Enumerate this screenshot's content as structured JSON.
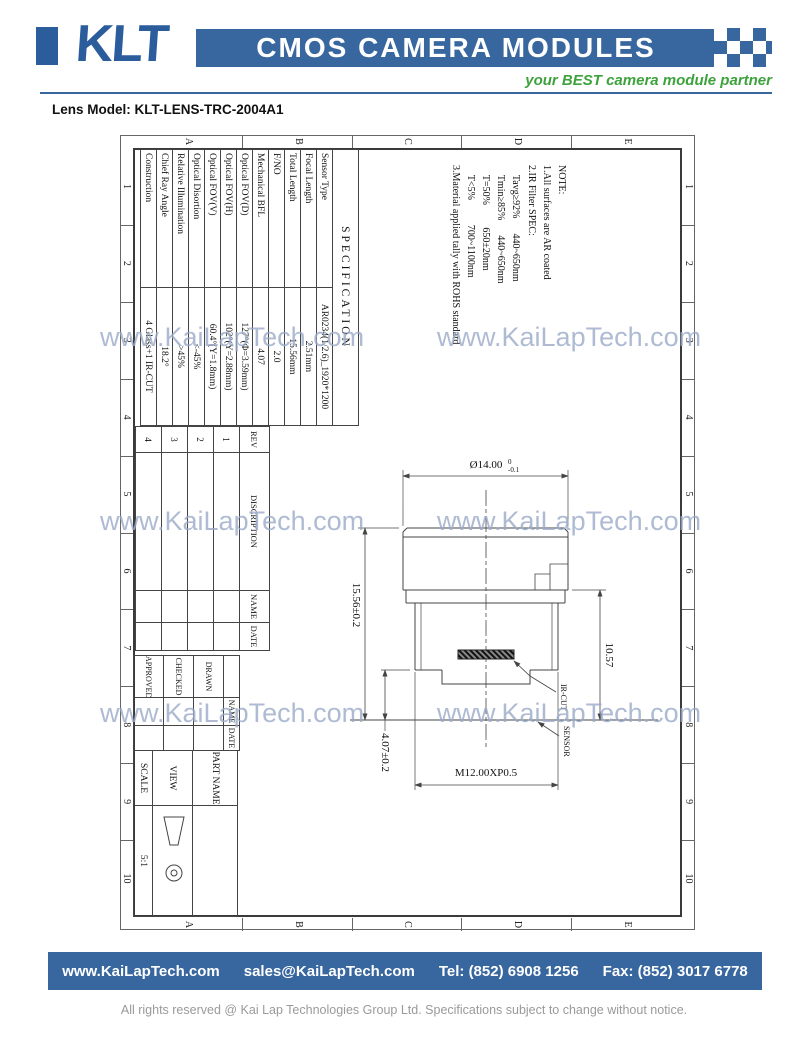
{
  "colors": {
    "brand_blue": "#38679F",
    "logo_blue": "#2B5C9C",
    "accent_green": "#3EA23C",
    "watermark_blue": "#9AABC9",
    "copyright_gray": "#9A9A9A",
    "line_dark": "#3A3A3A"
  },
  "header": {
    "logo_text": "KLT",
    "title": "CMOS CAMERA MODULES",
    "tagline": "your BEST camera module partner"
  },
  "lens_model": "Lens Model: KLT-LENS-TRC-2004A1",
  "watermark": {
    "text": "www.KaiLapTech.com"
  },
  "drawing": {
    "zones": {
      "columns": [
        "1",
        "2",
        "3",
        "4",
        "5",
        "6",
        "7",
        "8",
        "9",
        "10"
      ],
      "rows": [
        "A",
        "B",
        "C",
        "D",
        "E"
      ]
    },
    "note": {
      "lines": [
        "NOTE:",
        "1.All surfaces are AR coated",
        "2.IR Filter SPEC:",
        "    Tavg≥92%      440~650nm",
        "    Tmin≥85%      440~650nm",
        "    T=50%         650±20nm",
        "    T<5%          700~1100nm",
        "3.Material applied tally with ROHS standard"
      ]
    },
    "spec_table": {
      "title": "SPECIFICATION",
      "rows": [
        {
          "label": "Sensor Type",
          "value": "AR0234(1/2.6)_1920*1200"
        },
        {
          "label": "Focal Length",
          "value": "2.51mm"
        },
        {
          "label": "Total Length",
          "value": "15.56mm"
        },
        {
          "label": "F/NO",
          "value": "2.0"
        },
        {
          "label": "Mechanical BFL",
          "value": "4.07"
        },
        {
          "label": "Optical FOV(D)",
          "value": "127°(Φ=3.59mm)"
        },
        {
          "label": "Optical FOV(H)",
          "value": "102°(Y=2.88mm)"
        },
        {
          "label": "Optical FOV(V)",
          "value": "60.4°(Y=1.8mm)"
        },
        {
          "label": "Optical Disortion",
          "value": "<-45%"
        },
        {
          "label": "Relative Illumination",
          "value": ">45%"
        },
        {
          "label": "Chief Ray Angle",
          "value": "18.2°"
        },
        {
          "label": "Construction",
          "value": "4 Glass+1 IR-CUT"
        }
      ]
    },
    "rev_table": {
      "headers": [
        "REV",
        "DISCRIPTION",
        "NAME",
        "DATE"
      ],
      "rows": [
        "1",
        "2",
        "3",
        "4"
      ]
    },
    "approval_table": {
      "col_headers": [
        "NAME",
        "DATE"
      ],
      "row_labels": [
        "DRAWN",
        "CHECKED",
        "APPROVED"
      ]
    },
    "title_block": {
      "part_name_label": "PART NAME",
      "view_label": "VIEW",
      "scale_label": "SCALE",
      "scale_value": "5:1"
    },
    "dims": {
      "front_diameter": "Ø14.00",
      "front_diameter_tol_upper": "0",
      "front_diameter_tol_lower": "-0.1",
      "total_length": "15.56±0.2",
      "flange_to_sensor": "10.57",
      "rear_to_sensor": "4.07±0.2",
      "thread_spec": "M12.00XP0.5",
      "ir_cut_label": "IR-CUT",
      "sensor_label": "SENSOR"
    }
  },
  "footer": {
    "website": "www.KaiLapTech.com",
    "email": "sales@KaiLapTech.com",
    "tel": "Tel: (852) 6908 1256",
    "fax": "Fax: (852) 3017 6778",
    "copyright": "All rights reserved @ Kai Lap Technologies Group Ltd.  Specifications subject to change without notice."
  }
}
